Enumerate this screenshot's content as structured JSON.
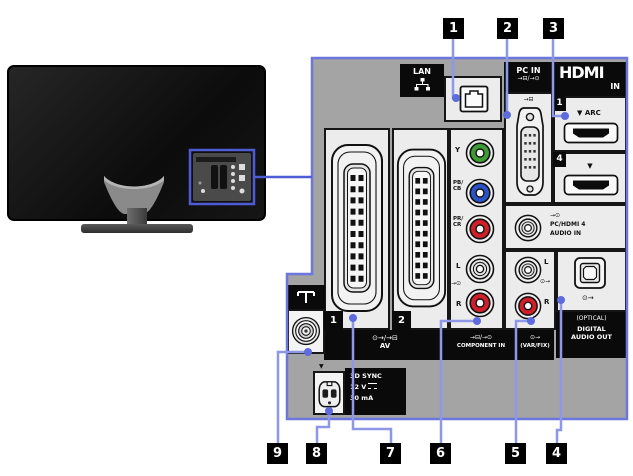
{
  "colors": {
    "callout_line": "#8e97e8",
    "callout_dot": "#5d6bdc",
    "panel_border": "#6b77dc",
    "highlight_blue": "#4d5cd4",
    "jack_green": "#3f9b35",
    "jack_blue": "#2953c6",
    "jack_red": "#cf1f2a",
    "jack_white": "#e4e4e4"
  },
  "callouts": {
    "top": [
      "1",
      "2",
      "3"
    ],
    "bottom": [
      "9",
      "8",
      "7",
      "6",
      "5",
      "4"
    ]
  },
  "icons": {
    "aerial": "aerial-icon",
    "dc_power": "dc-symbol-icon",
    "lan_network": "network-icon"
  },
  "panel": {
    "lan": {
      "label": "LAN"
    },
    "pc_in": {
      "label": "PC IN",
      "icons": "→⊟/→⊙",
      "port_icon": "→⊟"
    },
    "hdmi": {
      "logo": "HDMI",
      "logo_sub": "IN",
      "port1_num": "1",
      "port1_arc": "▼ ARC",
      "port4_num": "4",
      "port4_arrow": "▼"
    },
    "audio_in": {
      "icon": "→⊙",
      "line1": "PC/HDMI 4",
      "line2": "AUDIO IN"
    },
    "component": {
      "label_y": "Y",
      "label_pb1": "PB/",
      "label_pb2": "CB",
      "label_pr1": "PR/",
      "label_pr2": "CR",
      "label_l": "L",
      "label_r": "R",
      "icon_in": "→⊙",
      "strip_icons": "→⊟/→⊙",
      "strip_label": "COMPONENT IN"
    },
    "var_fix": {
      "label_l": "L",
      "label_r": "R",
      "icon_out": "⊙→",
      "strip_icon": "⊙→",
      "strip_label": "(VAR/FIX)"
    },
    "digital_out": {
      "icon_out": "⊙→",
      "optical": "(OPTICAL)",
      "line1": "DIGITAL",
      "line2": "AUDIO OUT"
    },
    "av": {
      "num1": "1",
      "num2": "2",
      "strip_icons": "⊙→/→⊟",
      "strip_label": "AV"
    },
    "sync3d": {
      "arrow": "▼",
      "line1": "3D SYNC",
      "line2": "12 V",
      "line3": "30 mA"
    }
  }
}
